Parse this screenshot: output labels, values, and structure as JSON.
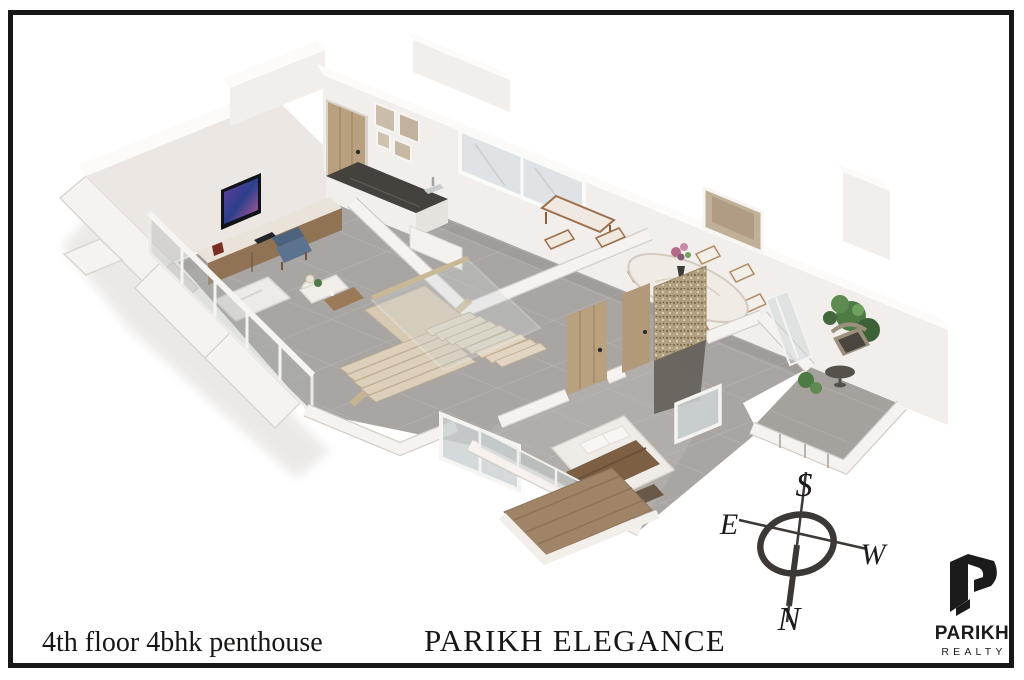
{
  "page": {
    "background": "#ffffff"
  },
  "frame": {
    "color": "#171717"
  },
  "footer": {
    "floor_label": "4th floor 4bhk penthouse",
    "project_title": "PARIKH ELEGANCE"
  },
  "compass": {
    "south": "S",
    "east": "E",
    "west": "W",
    "north": "N"
  },
  "brand": {
    "name": "PARIKH",
    "division": "REALTY",
    "mark": "stylized-3d-p"
  },
  "plan": {
    "palette": {
      "ink": "#1d1b1a",
      "wall": "#f1eeec",
      "wallInner": "#ece7e2",
      "wallTop": "#fcfbfa",
      "edge": "#d6d1cc",
      "floor": "#a9a5a2",
      "floorBedroom": "#b1adaa",
      "floorBalcony": "#a5a19d",
      "tileLine": "#c6c2bf",
      "wood": "#9b7a57",
      "woodLight": "#d8cab2",
      "woodDark": "#6e5742",
      "doorWood": "#b9a17f",
      "counter": "#45413d",
      "glass": "#aeb4b4",
      "marble": "#f0ebe4",
      "plant": "#4e7a44",
      "plantLight": "#6fa05e",
      "chairBlue": "#5c7390",
      "bedThrow": "#7d5f44",
      "deck": "#a08468",
      "mosaic": "#b3a184",
      "screenA": "#6a3fa0",
      "screenB": "#2b3f8a",
      "screenC": "#c05a9a"
    }
  }
}
